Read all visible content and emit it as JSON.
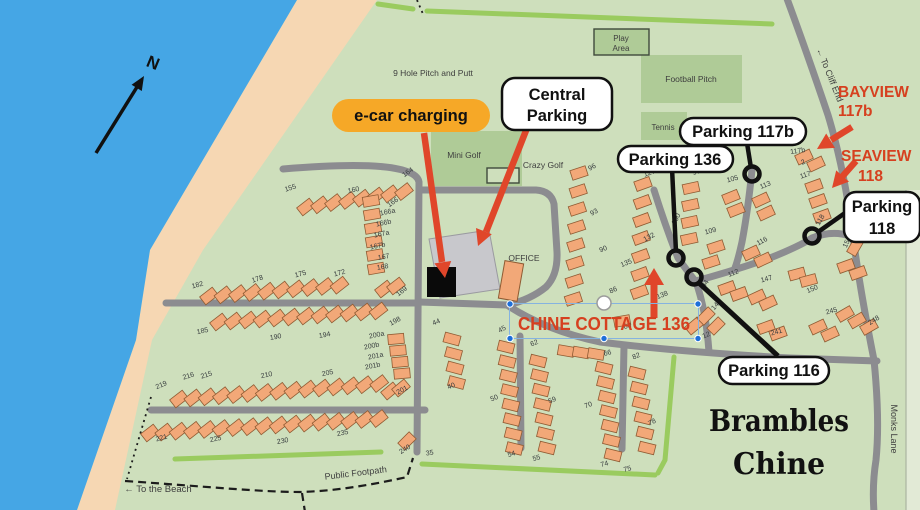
{
  "colors": {
    "sea": "#45A6E5",
    "beach": "#F6D7B3",
    "land": "#CEDFBC",
    "facility_green": "#AFCB97",
    "hedge_green": "#9ACB5F",
    "road_gray": "#8C8C90",
    "caravan_orange": "#F2A878",
    "annotation_red": "#E0462A",
    "ecar_pill_orange": "#F6A827",
    "parking_lot_gray": "#C8C8CC",
    "selection_blue": "#1E6FD9"
  },
  "compass": {
    "north": "N"
  },
  "areas": {
    "pitch_putt": "9 Hole Pitch and Putt",
    "mini_golf": "Mini Golf",
    "crazy_golf": "Crazy Golf",
    "play": [
      "Play",
      "Area"
    ],
    "football": "Football Pitch",
    "tennis": "Tennis",
    "office": "OFFICE"
  },
  "callouts": {
    "ecar": "e-car charging",
    "central_parking": [
      "Central",
      "Parking"
    ],
    "parking_117b": "Parking 117b",
    "parking_136": "Parking 136",
    "parking_118": [
      "Parking",
      "118"
    ],
    "parking_116": "Parking 116"
  },
  "highlights": {
    "bayview": [
      "BAYVIEW",
      "117b"
    ],
    "seaview": [
      "SEAVIEW",
      "118"
    ],
    "chine_cottage": "CHINE COTTAGE 136"
  },
  "wayfinding": {
    "to_cliff_end": "← To Cliff End",
    "monks_lane": "Monks Lane",
    "public_footpath": "Public Footpath",
    "to_beach": "← To the Beach",
    "park_name": [
      "Brambles",
      "Chine"
    ]
  },
  "map": {
    "caravan_labels": [
      {
        "t": "155",
        "x": 291,
        "y": 190,
        "r": -18
      },
      {
        "t": "160",
        "x": 354,
        "y": 192,
        "r": -12
      },
      {
        "t": "164",
        "x": 409,
        "y": 174,
        "r": -35
      },
      {
        "t": "166",
        "x": 394,
        "y": 204,
        "r": -35
      },
      {
        "t": "166a",
        "x": 388,
        "y": 214,
        "r": -12
      },
      {
        "t": "166b",
        "x": 384,
        "y": 225,
        "r": -12
      },
      {
        "t": "167a",
        "x": 382,
        "y": 236,
        "r": -12
      },
      {
        "t": "167b",
        "x": 378,
        "y": 248,
        "r": -12
      },
      {
        "t": "167",
        "x": 384,
        "y": 259,
        "r": -10
      },
      {
        "t": "168",
        "x": 383,
        "y": 269,
        "r": -10
      },
      {
        "t": "169",
        "x": 403,
        "y": 293,
        "r": -38
      },
      {
        "t": "182",
        "x": 198,
        "y": 287,
        "r": -15
      },
      {
        "t": "178",
        "x": 258,
        "y": 281,
        "r": -18
      },
      {
        "t": "175",
        "x": 301,
        "y": 276,
        "r": -15
      },
      {
        "t": "172",
        "x": 340,
        "y": 275,
        "r": -15
      },
      {
        "t": "185",
        "x": 203,
        "y": 333,
        "r": -12
      },
      {
        "t": "190",
        "x": 276,
        "y": 339,
        "r": -10
      },
      {
        "t": "194",
        "x": 325,
        "y": 337,
        "r": -10
      },
      {
        "t": "198",
        "x": 396,
        "y": 323,
        "r": -28
      },
      {
        "t": "200a",
        "x": 377,
        "y": 337,
        "r": -12
      },
      {
        "t": "200b",
        "x": 372,
        "y": 348,
        "r": -12
      },
      {
        "t": "201a",
        "x": 376,
        "y": 358,
        "r": -12
      },
      {
        "t": "201b",
        "x": 373,
        "y": 368,
        "r": -12
      },
      {
        "t": "219",
        "x": 162,
        "y": 387,
        "r": -22
      },
      {
        "t": "216",
        "x": 189,
        "y": 378,
        "r": -18
      },
      {
        "t": "215",
        "x": 207,
        "y": 377,
        "r": -18
      },
      {
        "t": "210",
        "x": 267,
        "y": 377,
        "r": -12
      },
      {
        "t": "205",
        "x": 328,
        "y": 375,
        "r": -12
      },
      {
        "t": "201",
        "x": 403,
        "y": 392,
        "r": -28
      },
      {
        "t": "221",
        "x": 162,
        "y": 440,
        "r": -15
      },
      {
        "t": "225",
        "x": 216,
        "y": 441,
        "r": -12
      },
      {
        "t": "230",
        "x": 283,
        "y": 443,
        "r": -10
      },
      {
        "t": "235",
        "x": 343,
        "y": 435,
        "r": -12
      },
      {
        "t": "240",
        "x": 406,
        "y": 451,
        "r": -32
      },
      {
        "t": "35",
        "x": 430,
        "y": 455,
        "r": -10
      },
      {
        "t": "44",
        "x": 437,
        "y": 324,
        "r": -22
      },
      {
        "t": "45",
        "x": 503,
        "y": 331,
        "r": -28
      },
      {
        "t": "40",
        "x": 452,
        "y": 388,
        "r": -22
      },
      {
        "t": "50",
        "x": 495,
        "y": 400,
        "r": -22
      },
      {
        "t": "54",
        "x": 512,
        "y": 456,
        "r": -15
      },
      {
        "t": "55",
        "x": 537,
        "y": 460,
        "r": -15
      },
      {
        "t": "59",
        "x": 553,
        "y": 402,
        "r": -22
      },
      {
        "t": "62",
        "x": 535,
        "y": 345,
        "r": -22
      },
      {
        "t": "66",
        "x": 608,
        "y": 355,
        "r": -15
      },
      {
        "t": "70",
        "x": 589,
        "y": 407,
        "r": -20
      },
      {
        "t": "74",
        "x": 605,
        "y": 466,
        "r": -15
      },
      {
        "t": "75",
        "x": 628,
        "y": 471,
        "r": -15
      },
      {
        "t": "78",
        "x": 653,
        "y": 424,
        "r": -28
      },
      {
        "t": "82",
        "x": 637,
        "y": 358,
        "r": -22
      },
      {
        "t": "96",
        "x": 593,
        "y": 169,
        "r": -28
      },
      {
        "t": "93",
        "x": 595,
        "y": 214,
        "r": -28
      },
      {
        "t": "90",
        "x": 604,
        "y": 251,
        "r": -22
      },
      {
        "t": "86",
        "x": 614,
        "y": 292,
        "r": -22
      },
      {
        "t": "127",
        "x": 650,
        "y": 175,
        "r": -18
      },
      {
        "t": "97",
        "x": 697,
        "y": 174,
        "r": -15
      },
      {
        "t": "105",
        "x": 733,
        "y": 181,
        "r": -15
      },
      {
        "t": "113",
        "x": 766,
        "y": 187,
        "r": -22
      },
      {
        "t": "100",
        "x": 678,
        "y": 220,
        "r": -62
      },
      {
        "t": "132",
        "x": 650,
        "y": 239,
        "r": -28
      },
      {
        "t": "135",
        "x": 627,
        "y": 265,
        "r": -22
      },
      {
        "t": "138",
        "x": 663,
        "y": 297,
        "r": -22
      },
      {
        "t": "83",
        "x": 628,
        "y": 328,
        "r": -15
      },
      {
        "t": "109",
        "x": 711,
        "y": 233,
        "r": -15
      },
      {
        "t": "116",
        "x": 763,
        "y": 243,
        "r": -28
      },
      {
        "t": "112",
        "x": 734,
        "y": 275,
        "r": -22
      },
      {
        "t": "147",
        "x": 767,
        "y": 281,
        "r": -15
      },
      {
        "t": "94",
        "x": 707,
        "y": 285,
        "r": -58
      },
      {
        "t": "143",
        "x": 718,
        "y": 306,
        "r": -50
      },
      {
        "t": "12",
        "x": 707,
        "y": 337,
        "r": -22
      },
      {
        "t": "117b",
        "x": 798,
        "y": 153,
        "r": -8
      },
      {
        "t": "2",
        "x": 804,
        "y": 164,
        "r": -25
      },
      {
        "t": "117",
        "x": 806,
        "y": 177,
        "r": -18
      },
      {
        "t": "118",
        "x": 822,
        "y": 221,
        "r": -60
      },
      {
        "t": "154",
        "x": 849,
        "y": 243,
        "r": -65
      },
      {
        "t": "150",
        "x": 813,
        "y": 291,
        "r": -22
      },
      {
        "t": "245",
        "x": 832,
        "y": 313,
        "r": -15
      },
      {
        "t": "248",
        "x": 875,
        "y": 322,
        "r": -32
      },
      {
        "t": "241",
        "x": 777,
        "y": 334,
        "r": -15
      }
    ],
    "caravan_rows": [
      {
        "x": 306,
        "y": 207,
        "dx": 14,
        "dy": -2.2,
        "n": 8,
        "r": -38
      },
      {
        "x": 371,
        "y": 201,
        "dx": 1,
        "dy": 13.5,
        "n": 6,
        "r": -10
      },
      {
        "x": 209,
        "y": 296,
        "dx": 14.5,
        "dy": -1.2,
        "n": 10,
        "r": -38
      },
      {
        "x": 384,
        "y": 289,
        "dx": 12,
        "dy": -3,
        "n": 2,
        "r": -38
      },
      {
        "x": 219,
        "y": 322,
        "dx": 14.5,
        "dy": -1,
        "n": 12,
        "r": -38
      },
      {
        "x": 396,
        "y": 339,
        "dx": 2,
        "dy": 11.5,
        "n": 4,
        "r": -5
      },
      {
        "x": 179,
        "y": 399,
        "dx": 14.3,
        "dy": -1.1,
        "n": 15,
        "r": -38
      },
      {
        "x": 390,
        "y": 391,
        "dx": 11,
        "dy": -3,
        "n": 2,
        "r": -40
      },
      {
        "x": 150,
        "y": 433,
        "dx": 14.3,
        "dy": -0.9,
        "n": 17,
        "r": -38
      },
      {
        "x": 407,
        "y": 441,
        "dx": 9,
        "dy": 7,
        "n": 1,
        "r": -45
      },
      {
        "x": 452,
        "y": 339,
        "dx": 1.5,
        "dy": 14.5,
        "n": 4,
        "r": 15
      },
      {
        "x": 506,
        "y": 347,
        "dx": 1.2,
        "dy": 14.5,
        "n": 8,
        "r": 14
      },
      {
        "x": 538,
        "y": 361,
        "dx": 1.5,
        "dy": 14.5,
        "n": 7,
        "r": 14
      },
      {
        "x": 566,
        "y": 351,
        "dx": 15,
        "dy": 1.5,
        "n": 3,
        "r": 10
      },
      {
        "x": 604,
        "y": 368,
        "dx": 1.5,
        "dy": 14.5,
        "n": 7,
        "r": 14
      },
      {
        "x": 637,
        "y": 373,
        "dx": 2,
        "dy": 15,
        "n": 6,
        "r": 14
      },
      {
        "x": 579,
        "y": 173,
        "dx": -0.8,
        "dy": 18,
        "n": 8,
        "r": -18
      },
      {
        "x": 643,
        "y": 184,
        "dx": -0.6,
        "dy": 18,
        "n": 7,
        "r": -20
      },
      {
        "x": 622,
        "y": 321,
        "dx": 10,
        "dy": 5,
        "n": 1,
        "r": -10
      },
      {
        "x": 694,
        "y": 326,
        "dx": 10,
        "dy": 5,
        "n": 1,
        "r": -40
      },
      {
        "x": 691,
        "y": 188,
        "dx": -0.6,
        "dy": 17,
        "n": 4,
        "r": -12
      },
      {
        "x": 731,
        "y": 197,
        "dx": 5,
        "dy": 13,
        "n": 2,
        "r": -22
      },
      {
        "x": 761,
        "y": 200,
        "dx": 5,
        "dy": 13,
        "n": 2,
        "r": -25
      },
      {
        "x": 716,
        "y": 247,
        "dx": -5,
        "dy": 15,
        "n": 2,
        "r": -18
      },
      {
        "x": 751,
        "y": 253,
        "dx": 12,
        "dy": 7,
        "n": 2,
        "r": -25
      },
      {
        "x": 727,
        "y": 288,
        "dx": 12,
        "dy": 6,
        "n": 2,
        "r": -20
      },
      {
        "x": 757,
        "y": 297,
        "dx": 11,
        "dy": 6,
        "n": 2,
        "r": -25
      },
      {
        "x": 706,
        "y": 316,
        "dx": 10,
        "dy": 10,
        "n": 2,
        "r": -45
      },
      {
        "x": 804,
        "y": 157,
        "dx": 12,
        "dy": 7,
        "n": 2,
        "r": -25
      },
      {
        "x": 814,
        "y": 186,
        "dx": 4,
        "dy": 15,
        "n": 3,
        "r": -20
      },
      {
        "x": 797,
        "y": 274,
        "dx": 11.5,
        "dy": 6.5,
        "n": 2,
        "r": -15
      },
      {
        "x": 846,
        "y": 266,
        "dx": 12,
        "dy": 7,
        "n": 2,
        "r": -20
      },
      {
        "x": 855,
        "y": 247,
        "dx": 0,
        "dy": 0,
        "n": 1,
        "r": -60
      },
      {
        "x": 818,
        "y": 327,
        "dx": 12,
        "dy": 7,
        "n": 2,
        "r": -25
      },
      {
        "x": 845,
        "y": 314,
        "dx": 12,
        "dy": 6.5,
        "n": 3,
        "r": -30
      },
      {
        "x": 766,
        "y": 327,
        "dx": 12,
        "dy": 6.5,
        "n": 2,
        "r": -20
      }
    ]
  }
}
